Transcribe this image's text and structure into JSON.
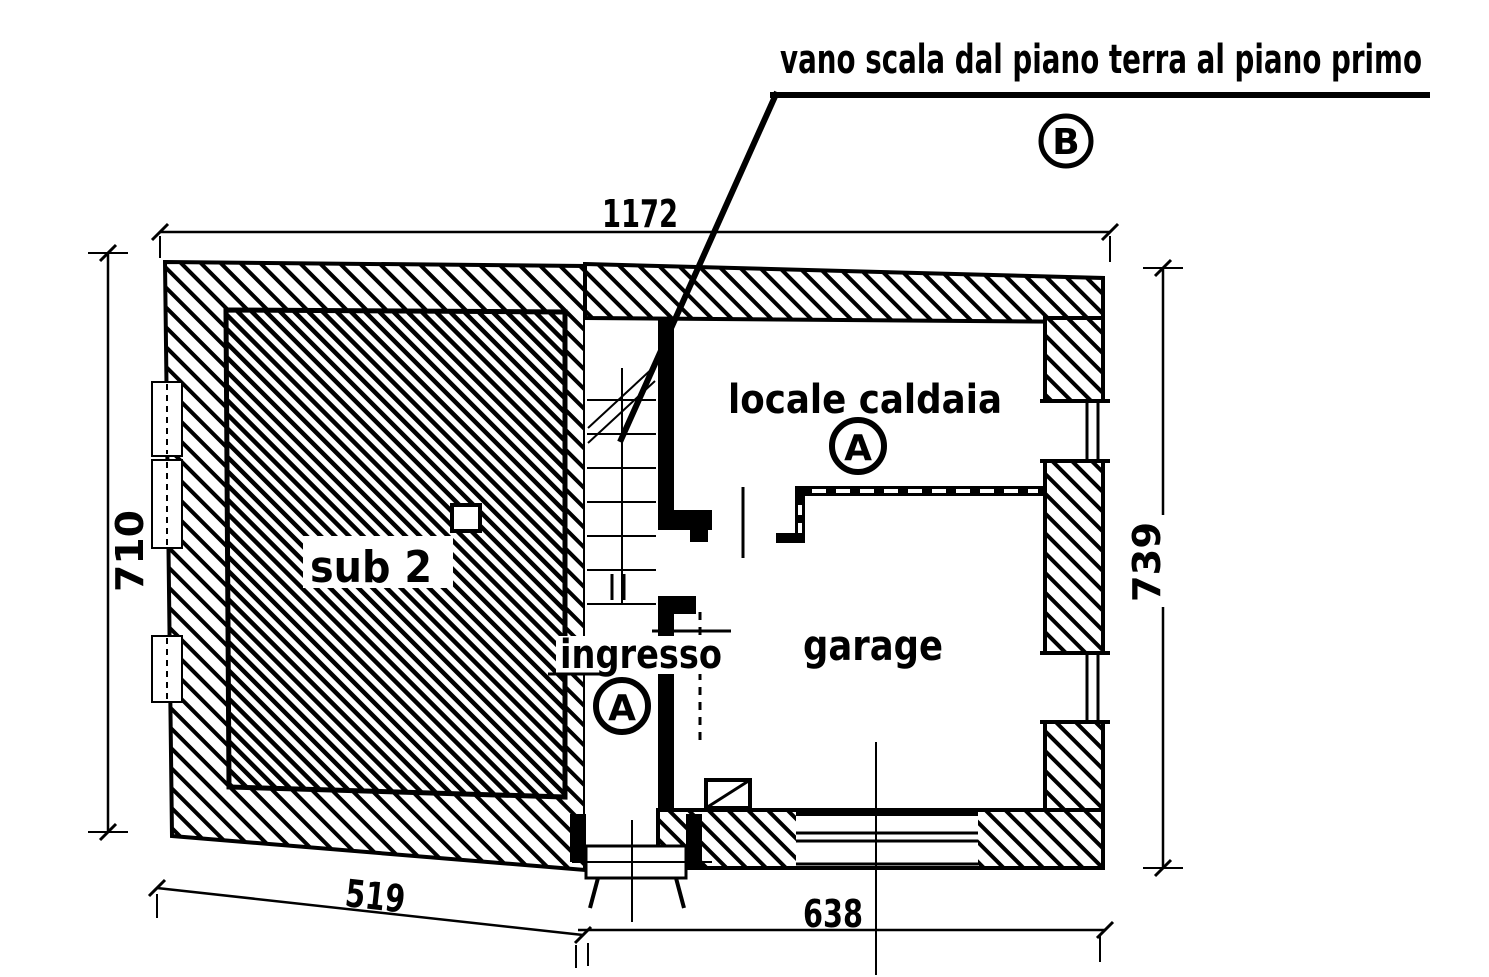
{
  "annotation": {
    "callout": "vano scala dal piano terra al piano primo"
  },
  "markers": {
    "section_b": "B",
    "section_a_caldaia": "A",
    "section_a_ingresso": "A"
  },
  "room_labels": {
    "sub2": "sub 2",
    "locale_caldaia": "locale caldaia",
    "ingresso": "ingresso",
    "garage": "garage"
  },
  "dimensions": {
    "top_width": "1172",
    "left_height": "710",
    "right_height": "739",
    "bottom_left_width": "519",
    "bottom_right_width": "638"
  },
  "colors": {
    "ink": "#000000",
    "paper": "#ffffff"
  }
}
